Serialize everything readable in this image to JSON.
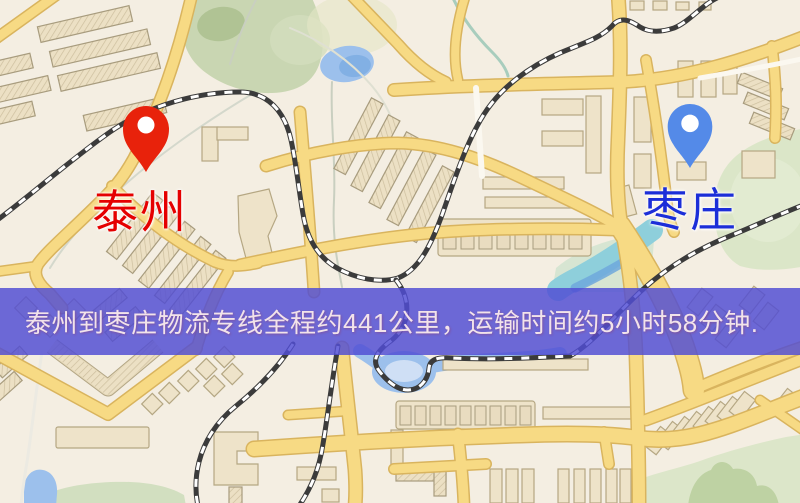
{
  "banner": {
    "text": "泰州到枣庄物流专线全程约441公里，运输时间约5小时58分钟.",
    "distance_text": "441公里",
    "duration_text": "5小时58分钟"
  },
  "markers": {
    "origin": {
      "label": "泰州",
      "icon": "origin-pin-icon"
    },
    "destination": {
      "label": "枣庄",
      "icon": "destination-pin-icon"
    }
  },
  "palette": {
    "ground": "#f4eee2",
    "road_fill": "#f7da84",
    "road_casing": "#d9b45e",
    "building_fill": "#eee3c9",
    "building_stroke": "#b5a783",
    "railway": "#3b3b3b",
    "park": "#c9d6b2",
    "park_light": "#dbe6c8",
    "water": "#9cc0ec",
    "water_teal": "#8ecfdb",
    "banner_bg": "rgba(80,77,212,0.83)",
    "banner_text": "#f2e3ea",
    "label_origin": "#e50000",
    "label_dest": "#1c2ed8",
    "pin_origin": "#e8220b",
    "pin_dest": "#548ae8"
  }
}
